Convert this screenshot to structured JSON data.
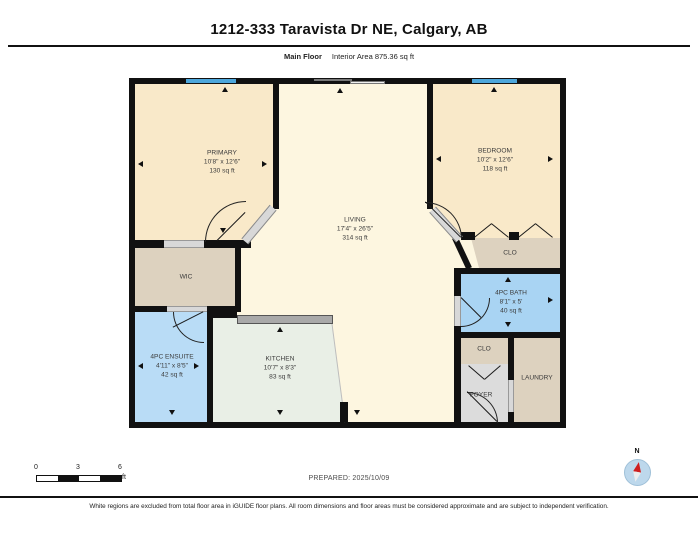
{
  "header": {
    "title": "1212-333 Taravista Dr NE, Calgary, AB",
    "floor_label": "Main Floor",
    "area_label": "Interior Area 875.36 sq ft"
  },
  "rooms": [
    {
      "name": "PRIMARY",
      "dims": "10'8\" x 12'6\"",
      "area": "130 sq ft"
    },
    {
      "name": "BEDROOM",
      "dims": "10'2\" x 12'6\"",
      "area": "118 sq ft"
    },
    {
      "name": "LIVING",
      "dims": "17'4\" x 26'5\"",
      "area": "314 sq ft"
    },
    {
      "name": "WIC"
    },
    {
      "name": "4PC ENSUITE",
      "dims": "4'11\" x 8'5\"",
      "area": "42 sq ft"
    },
    {
      "name": "KITCHEN",
      "dims": "10'7\" x 8'3\"",
      "area": "83 sq ft"
    },
    {
      "name": "4PC BATH",
      "dims": "8'1\" x 5'",
      "area": "40 sq ft"
    },
    {
      "name": "CLO"
    },
    {
      "name": "CLO"
    },
    {
      "name": "LAUNDRY"
    },
    {
      "name": "FOYER"
    }
  ],
  "scale_bar": {
    "ticks": [
      "0",
      "3",
      "6"
    ],
    "unit": "ft"
  },
  "prepared": "PREPARED: 2025/10/09",
  "compass": {
    "label": "N"
  },
  "footer": "White regions are excluded from total floor area in iGUIDE floor plans. All room dimensions and floor areas must be considered approximate and are subject to independent verification.",
  "colors": {
    "wall": "#111111",
    "bedroom_fill": "#f9e9c9",
    "living_fill": "#fdf6e0",
    "closet_fill": "#ddd2bf",
    "bath_fill": "#a9d4f3",
    "ensuite_fill": "#b9dcf6",
    "kitchen_fill": "#e9efe6",
    "foyer_fill": "#dcdcdc",
    "window_blue": "#4da7dc",
    "counter_gray": "#a9a9a9",
    "compass_red": "#cf1f1f"
  }
}
